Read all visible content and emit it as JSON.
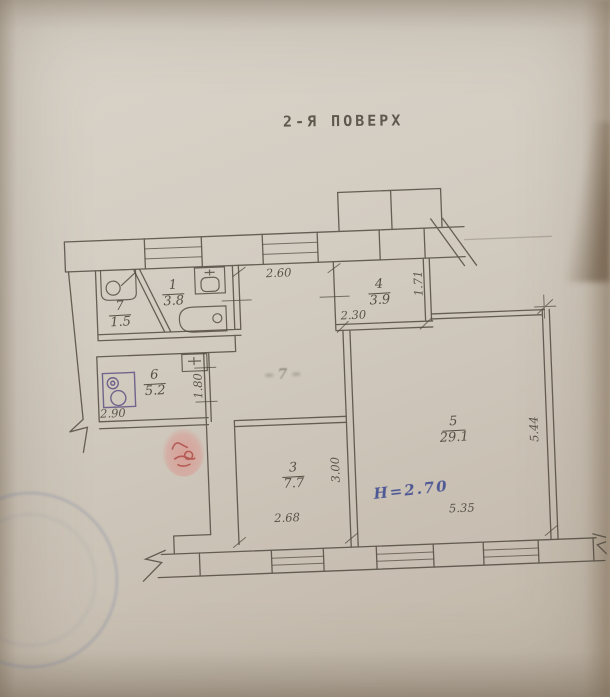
{
  "title": "2-Я ПОВЕРХ",
  "handwritten_note": "Н=2.70",
  "plan": {
    "rooms": [
      {
        "number": "7",
        "area": "1.5"
      },
      {
        "number": "1",
        "area": "3.8"
      },
      {
        "number": "4",
        "area": "3.9"
      },
      {
        "number": "6",
        "area": "5.2"
      },
      {
        "number": "3",
        "area": "7.7"
      },
      {
        "number": "5",
        "area": "29.1"
      }
    ],
    "faint_room_mark": "7",
    "dimensions": {
      "hall_top": "2.60",
      "room4_width": "2.30",
      "room4_depth": "1.71",
      "kitchen_width": "2.90",
      "kitchen_depth": "1.80",
      "room3_width": "2.68",
      "room3_depth": "3.00",
      "room5_width": "5.35",
      "room5_depth": "5.44"
    },
    "fixtures": [
      "washbasin-icon",
      "toilet-icon",
      "bathtub-icon",
      "stove-icon",
      "kitchen-sink-icon"
    ]
  },
  "colors": {
    "paper": "#d3ccc1",
    "ink": "#4e463c",
    "blue_ink": "#33418e",
    "red_stamp": "#c0504a",
    "blue_stamp": "#6c80a8",
    "fixture_purple": "#5f5383"
  }
}
